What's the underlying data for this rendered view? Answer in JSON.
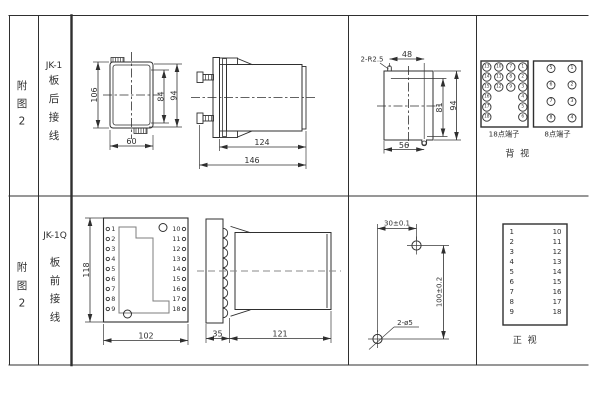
{
  "rows": [
    {
      "fig": [
        "附",
        "图",
        "2"
      ],
      "model": "JK-1",
      "wiring": [
        "板",
        "后",
        "接",
        "线"
      ]
    },
    {
      "fig": [
        "附",
        "图",
        "2"
      ],
      "model": "JK-1Q",
      "wiring": [
        "板",
        "前",
        "接",
        "线"
      ]
    }
  ],
  "jk1": {
    "front": {
      "h": "106",
      "inner_h": "84",
      "outer_h": "94",
      "w": "60"
    },
    "side": {
      "depth": "124",
      "total": "146"
    },
    "cutout": {
      "note": "2-R2.5",
      "top_w": "48",
      "h1": "81",
      "h2": "94",
      "bottom_w": "56"
    },
    "t18": {
      "label": "18点端子",
      "n": [
        "13",
        "10",
        "7",
        "1",
        "14",
        "11",
        "8",
        "2",
        "15",
        "12",
        "9",
        "3",
        "16",
        "4",
        "17",
        "5",
        "18",
        "6"
      ]
    },
    "t8": {
      "label": "8点端子",
      "n": [
        "5",
        "1",
        "6",
        "2",
        "7",
        "3",
        "8",
        "4"
      ]
    },
    "caption": "背  视"
  },
  "jk1q": {
    "front": {
      "h": "118",
      "w": "102"
    },
    "side": {
      "flange": "35",
      "depth": "121"
    },
    "drill": {
      "dx": "30±0.1",
      "dy": "100±0.2",
      "note": "2-ø5"
    },
    "tl": [
      "1",
      "2",
      "3",
      "4",
      "5",
      "6",
      "7",
      "8",
      "9"
    ],
    "tr": [
      "10",
      "11",
      "12",
      "13",
      "14",
      "15",
      "16",
      "17",
      "18"
    ],
    "caption": "正  视"
  }
}
